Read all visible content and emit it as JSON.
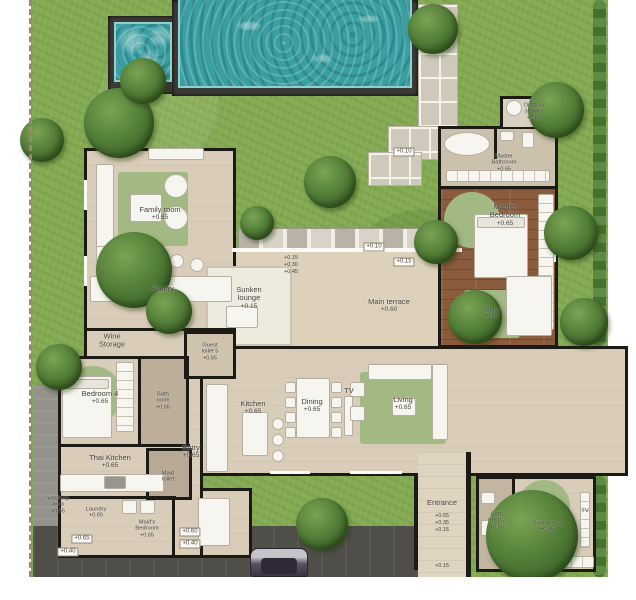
{
  "plan": {
    "title": "Pool villa ground floor plan"
  },
  "rooms": {
    "family_room": {
      "label": "Family room",
      "elev": "+0.65"
    },
    "pantry": {
      "label": "Pantry"
    },
    "wine_storage": {
      "label": "Wine\nStorage"
    },
    "guest_toilet": {
      "label": "Guest\ntoilet 5",
      "elev": "+0.65"
    },
    "bedroom4": {
      "label": "Bedroom 4",
      "elev": "+0.65"
    },
    "bathroom4": {
      "label": "Bath\nroom",
      "elev": "+0.65"
    },
    "thai_kitchen": {
      "label": "Thai Kitchen",
      "elev": "+0.65"
    },
    "laundry": {
      "label": "Laundry",
      "elev": "+0.65"
    },
    "maids_bedroom": {
      "label": "Maid's\nBedroom",
      "elev": "+0.65"
    },
    "maid_toilet": {
      "label": "Maid\ntoilet"
    },
    "entry": {
      "label": "Entry",
      "elev": "+0.65"
    },
    "kitchen": {
      "label": "Kitchen",
      "elev": "+0.65"
    },
    "dining": {
      "label": "Dining",
      "elev": "+0.65"
    },
    "tv": {
      "label": "TV"
    },
    "living": {
      "label": "Living",
      "elev": "+0.65"
    },
    "sunken_lounge": {
      "label": "Sunken\nlounge",
      "elev": "+0.15"
    },
    "main_terrace": {
      "label": "Main terrace",
      "elev": "+0.60"
    },
    "master_bedroom": {
      "label": "Master\nBedroom",
      "elev": "+0.65"
    },
    "master_bathroom": {
      "label": "Master\nBathroom",
      "elev": "+0.65"
    },
    "outdoor_shower": {
      "label": "Outdoor\nshower",
      "elev": "+0.55"
    },
    "sitting": {
      "label": "Sitting",
      "elev": "+0.65"
    },
    "entrance": {
      "label": "Entrance"
    },
    "bathroom2": {
      "label": "Bath\nroom 2",
      "elev": "+0.65"
    },
    "bedroom2": {
      "label": "Bedroom 2",
      "elev": "+0.65"
    },
    "washing_area": {
      "label": "washing\narea",
      "elev": "+0.55"
    },
    "tv2": {
      "label": "TV"
    }
  },
  "markers": {
    "p010": "+0.10",
    "p015": "+0.15",
    "p030": "+0.30",
    "p045": "+0.45",
    "p065": "+0.65",
    "p060": "+0.60",
    "p040": "+0.40",
    "p035": "+0.35",
    "p025": "+0.25"
  },
  "palette": {
    "grass": "#84aa52",
    "tree": "#4a7434",
    "pool_water": "#3a9fa2",
    "floor": "#d9cdb9",
    "wood_floor": "#8a5b3d",
    "wall": "#1b1a14",
    "terrace": "#ddd1bc",
    "driveway": "#504e49",
    "rug": "#a3b984",
    "paver": "#cfc9bb"
  }
}
